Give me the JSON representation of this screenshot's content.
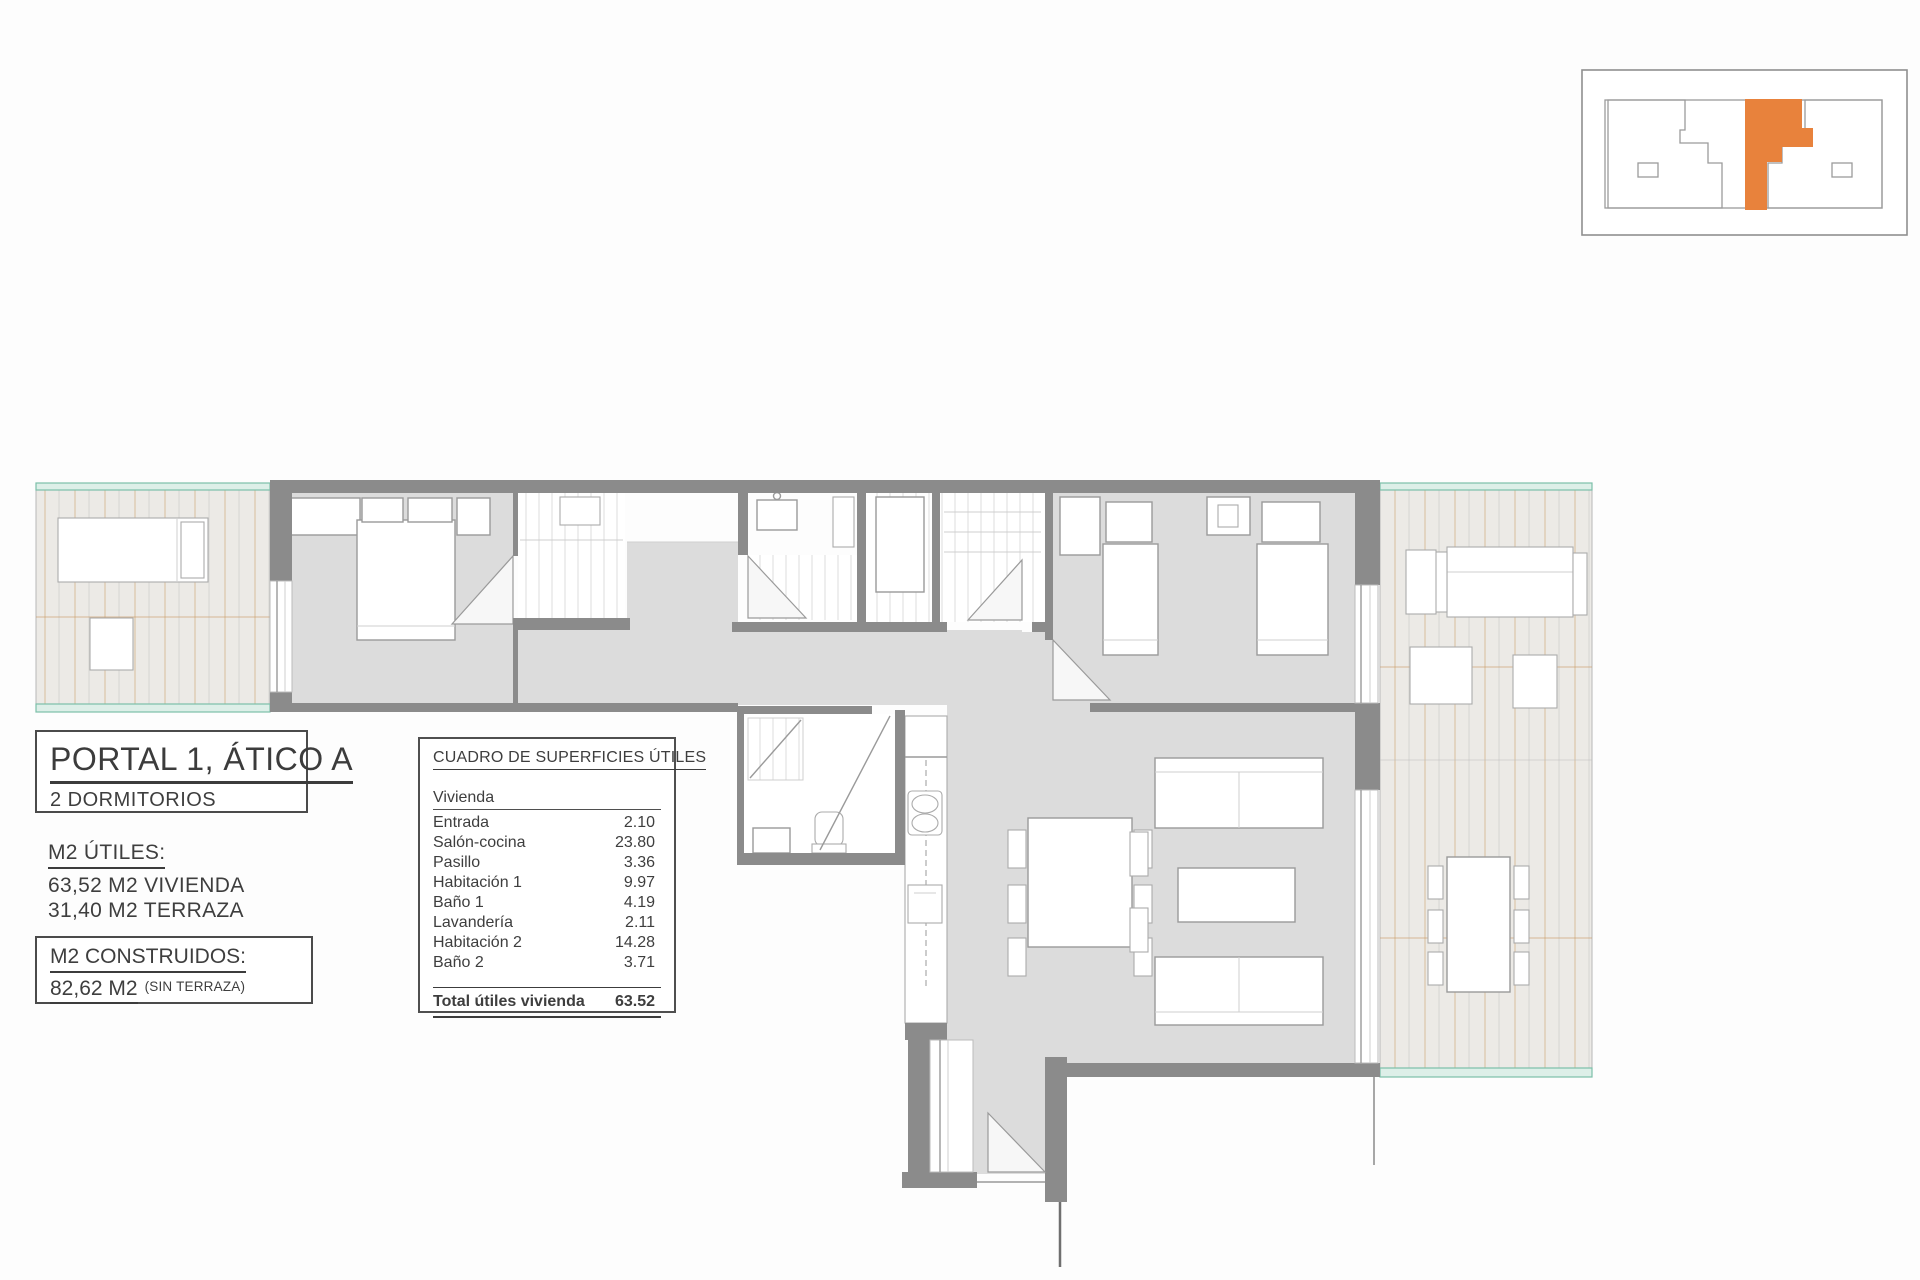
{
  "colors": {
    "accent": "#E8823C",
    "teal": "#7CBFA9",
    "wall": "#8B8B8B",
    "floor": "#DCDCDC",
    "terrace_line": "#C9965E"
  },
  "title_box": {
    "title": "PORTAL 1, ÁTICO A",
    "subtitle": "2 DORMITORIOS"
  },
  "areas_utiles": {
    "heading": "M2 ÚTILES:",
    "line1": "63,52 M2 VIVIENDA",
    "line2": "31,40 M2 TERRAZA"
  },
  "areas_construidos": {
    "heading": "M2 CONSTRUIDOS:",
    "value": "82,62 M2",
    "note": "(SIN TERRAZA)"
  },
  "surfaces_table": {
    "heading": "CUADRO DE SUPERFICIES ÚTILES",
    "group_label": "Vivienda",
    "rows": [
      {
        "name": "Entrada",
        "value": "2.10"
      },
      {
        "name": "Salón-cocina",
        "value": "23.80"
      },
      {
        "name": "Pasillo",
        "value": "3.36"
      },
      {
        "name": "Habitación 1",
        "value": "9.97"
      },
      {
        "name": "Baño 1",
        "value": "4.19"
      },
      {
        "name": "Lavandería",
        "value": "2.11"
      },
      {
        "name": "Habitación 2",
        "value": "14.28"
      },
      {
        "name": "Baño 2",
        "value": "3.71"
      }
    ],
    "total_label": "Total útiles vivienda",
    "total_value": "63.52"
  }
}
